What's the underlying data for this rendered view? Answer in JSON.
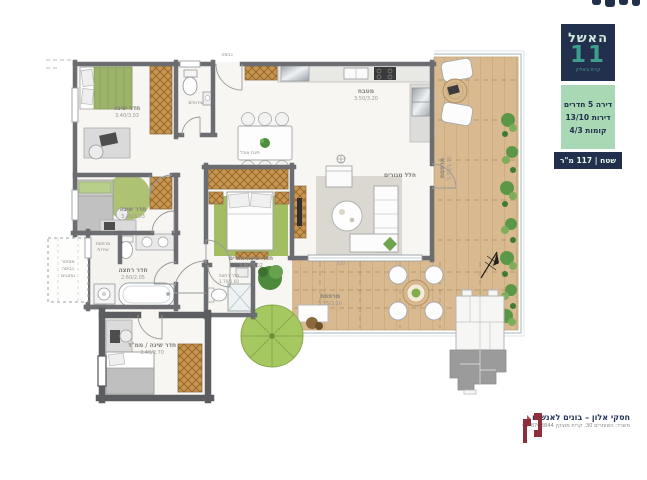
{
  "colors": {
    "brand_navy": "#22304d",
    "brand_mint": "#a8d8b4",
    "brand_teal": "#3f9d8c",
    "developer_maroon": "#8e2f3c",
    "wood": "#c6954f",
    "deck": "#d9ba90",
    "green_rug": "#a3bd62"
  },
  "brand": {
    "name": "האשל",
    "number": "11",
    "city": "קרית ביאליק",
    "spec_lines": [
      "דירה 5 חדרים",
      "דירות 13/10",
      "קומות 4/3"
    ],
    "area": "שטח | 117 מ\"ר"
  },
  "plan": {
    "entrance": "כניסה",
    "bedroom1": {
      "label": "חדר שינה",
      "dims": "3.40/3.03"
    },
    "bedroom2": {
      "label": "חדר שינה",
      "dims": "3.45/3.03"
    },
    "toilet": {
      "label": "שירותים"
    },
    "kitchen": {
      "label": "מטבח",
      "dims": "3.50/3.20"
    },
    "dining": {
      "label": "פינת אוכל"
    },
    "living": {
      "label": "חלל מגורים"
    },
    "master": {
      "label": "חדר שינה הורים",
      "dims": "3.60/3.02"
    },
    "master_bath": {
      "label": "חדר רחצה",
      "dims": "1.70/1.60"
    },
    "bathroom": {
      "label": "חדר רחצה",
      "dims": "2.60/2.05"
    },
    "service": {
      "line1": "מרפסת",
      "line2": "שירות"
    },
    "laundry": {
      "line1": "מסתור",
      "line2": "כביסה",
      "line3": "ומזגנים"
    },
    "mamad": {
      "label": "חדר שינה / ממ\"ד",
      "dims": "3.40/2.70"
    },
    "balcony_side": {
      "label": "מרפסת",
      "dims": "5.70/1.75"
    },
    "balcony_main": {
      "label": "מרפסת",
      "dims": "5.75/3.10"
    },
    "dim_note": "430"
  },
  "developer": {
    "name": "חסקי אלון – בונים לאנשים",
    "address": "משרד: השומרים 30, קרית מוצקין 04-8708844"
  }
}
